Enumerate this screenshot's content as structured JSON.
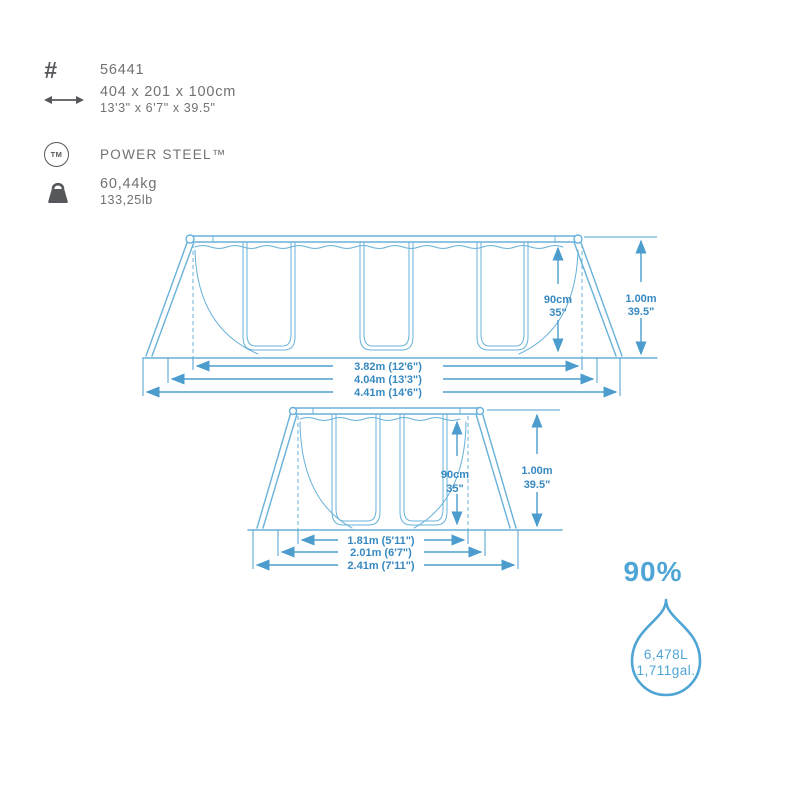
{
  "colors": {
    "diagram_blue": "#68B1D9",
    "dimension_line_blue": "#4C9DCE",
    "dimension_text_blue": "#3789C1",
    "capacity_blue": "#4FA5D5",
    "icon_gray": "#55575B",
    "text_gray": "#707174",
    "background": "#ffffff"
  },
  "specs": {
    "hash_symbol": "#",
    "tm_symbol": "TM",
    "item_number": "56441",
    "size_metric": "404 x 201 x 100cm",
    "size_imperial": "13'3\" x 6'7\" x 39.5\"",
    "brand": "POWER STEEL™",
    "weight_metric": "60,44kg",
    "weight_imperial": "133,25lb",
    "icons": {
      "item_number": "hash-icon",
      "size": "double-arrow-icon",
      "brand": "trademark-icon",
      "weight": "weight-kettlebell-icon",
      "capacity": "water-drop-icon"
    }
  },
  "side_view": {
    "length_pool": "3.82m (12'6\")",
    "length_frame": "4.04m (13'3\")",
    "length_total": "4.41m (14'6\")",
    "water_height": "90cm",
    "water_height_in": "35\"",
    "total_height": "1.00m",
    "total_height_in": "39.5\""
  },
  "end_view": {
    "width_pool": "1.81m (5'11\")",
    "width_frame": "2.01m (6'7\")",
    "width_total": "2.41m (7'11\")",
    "water_height": "90cm",
    "water_height_in": "35\"",
    "total_height": "1.00m",
    "total_height_in": "39.5\""
  },
  "capacity": {
    "fill_percent": "90%",
    "liters": "6,478L",
    "gallons": "1,711gal."
  }
}
